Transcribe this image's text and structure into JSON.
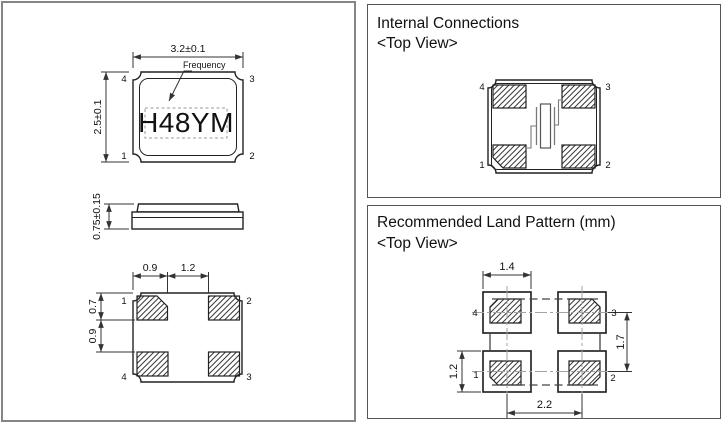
{
  "package_panel": {
    "top_view": {
      "width_dim": "3.2±0.1",
      "height_dim": "2.5±0.1",
      "frequency_label": "Frequency",
      "marking": "H48YM",
      "pin_tl": "4",
      "pin_tr": "3",
      "pin_bl": "1",
      "pin_br": "2"
    },
    "side_view": {
      "height_dim": "0.75±0.15"
    },
    "bottom_view": {
      "pad_width_dim": "0.9",
      "gap_width_dim": "1.2",
      "pad_height_dim": "0.7",
      "gap_height_dim": "0.9",
      "pin_tl": "1",
      "pin_tr": "2",
      "pin_bl": "4",
      "pin_br": "3"
    }
  },
  "internal_panel": {
    "title": "Internal Connections",
    "subtitle": "<Top View>",
    "pin_tl": "4",
    "pin_tr": "3",
    "pin_bl": "1",
    "pin_br": "2"
  },
  "land_panel": {
    "title": "Recommended Land Pattern (mm)",
    "subtitle": "<Top View>",
    "pad_width_dim": "1.4",
    "row_pitch_dim": "1.7",
    "pad_height_dim": "1.2",
    "col_pitch_dim": "2.2",
    "pin_tl": "4",
    "pin_tr": "3",
    "pin_bl": "1",
    "pin_br": "2"
  },
  "colors": {
    "line": "#222222",
    "hatch": "#3a3a3a",
    "panel_border": "#565656"
  }
}
